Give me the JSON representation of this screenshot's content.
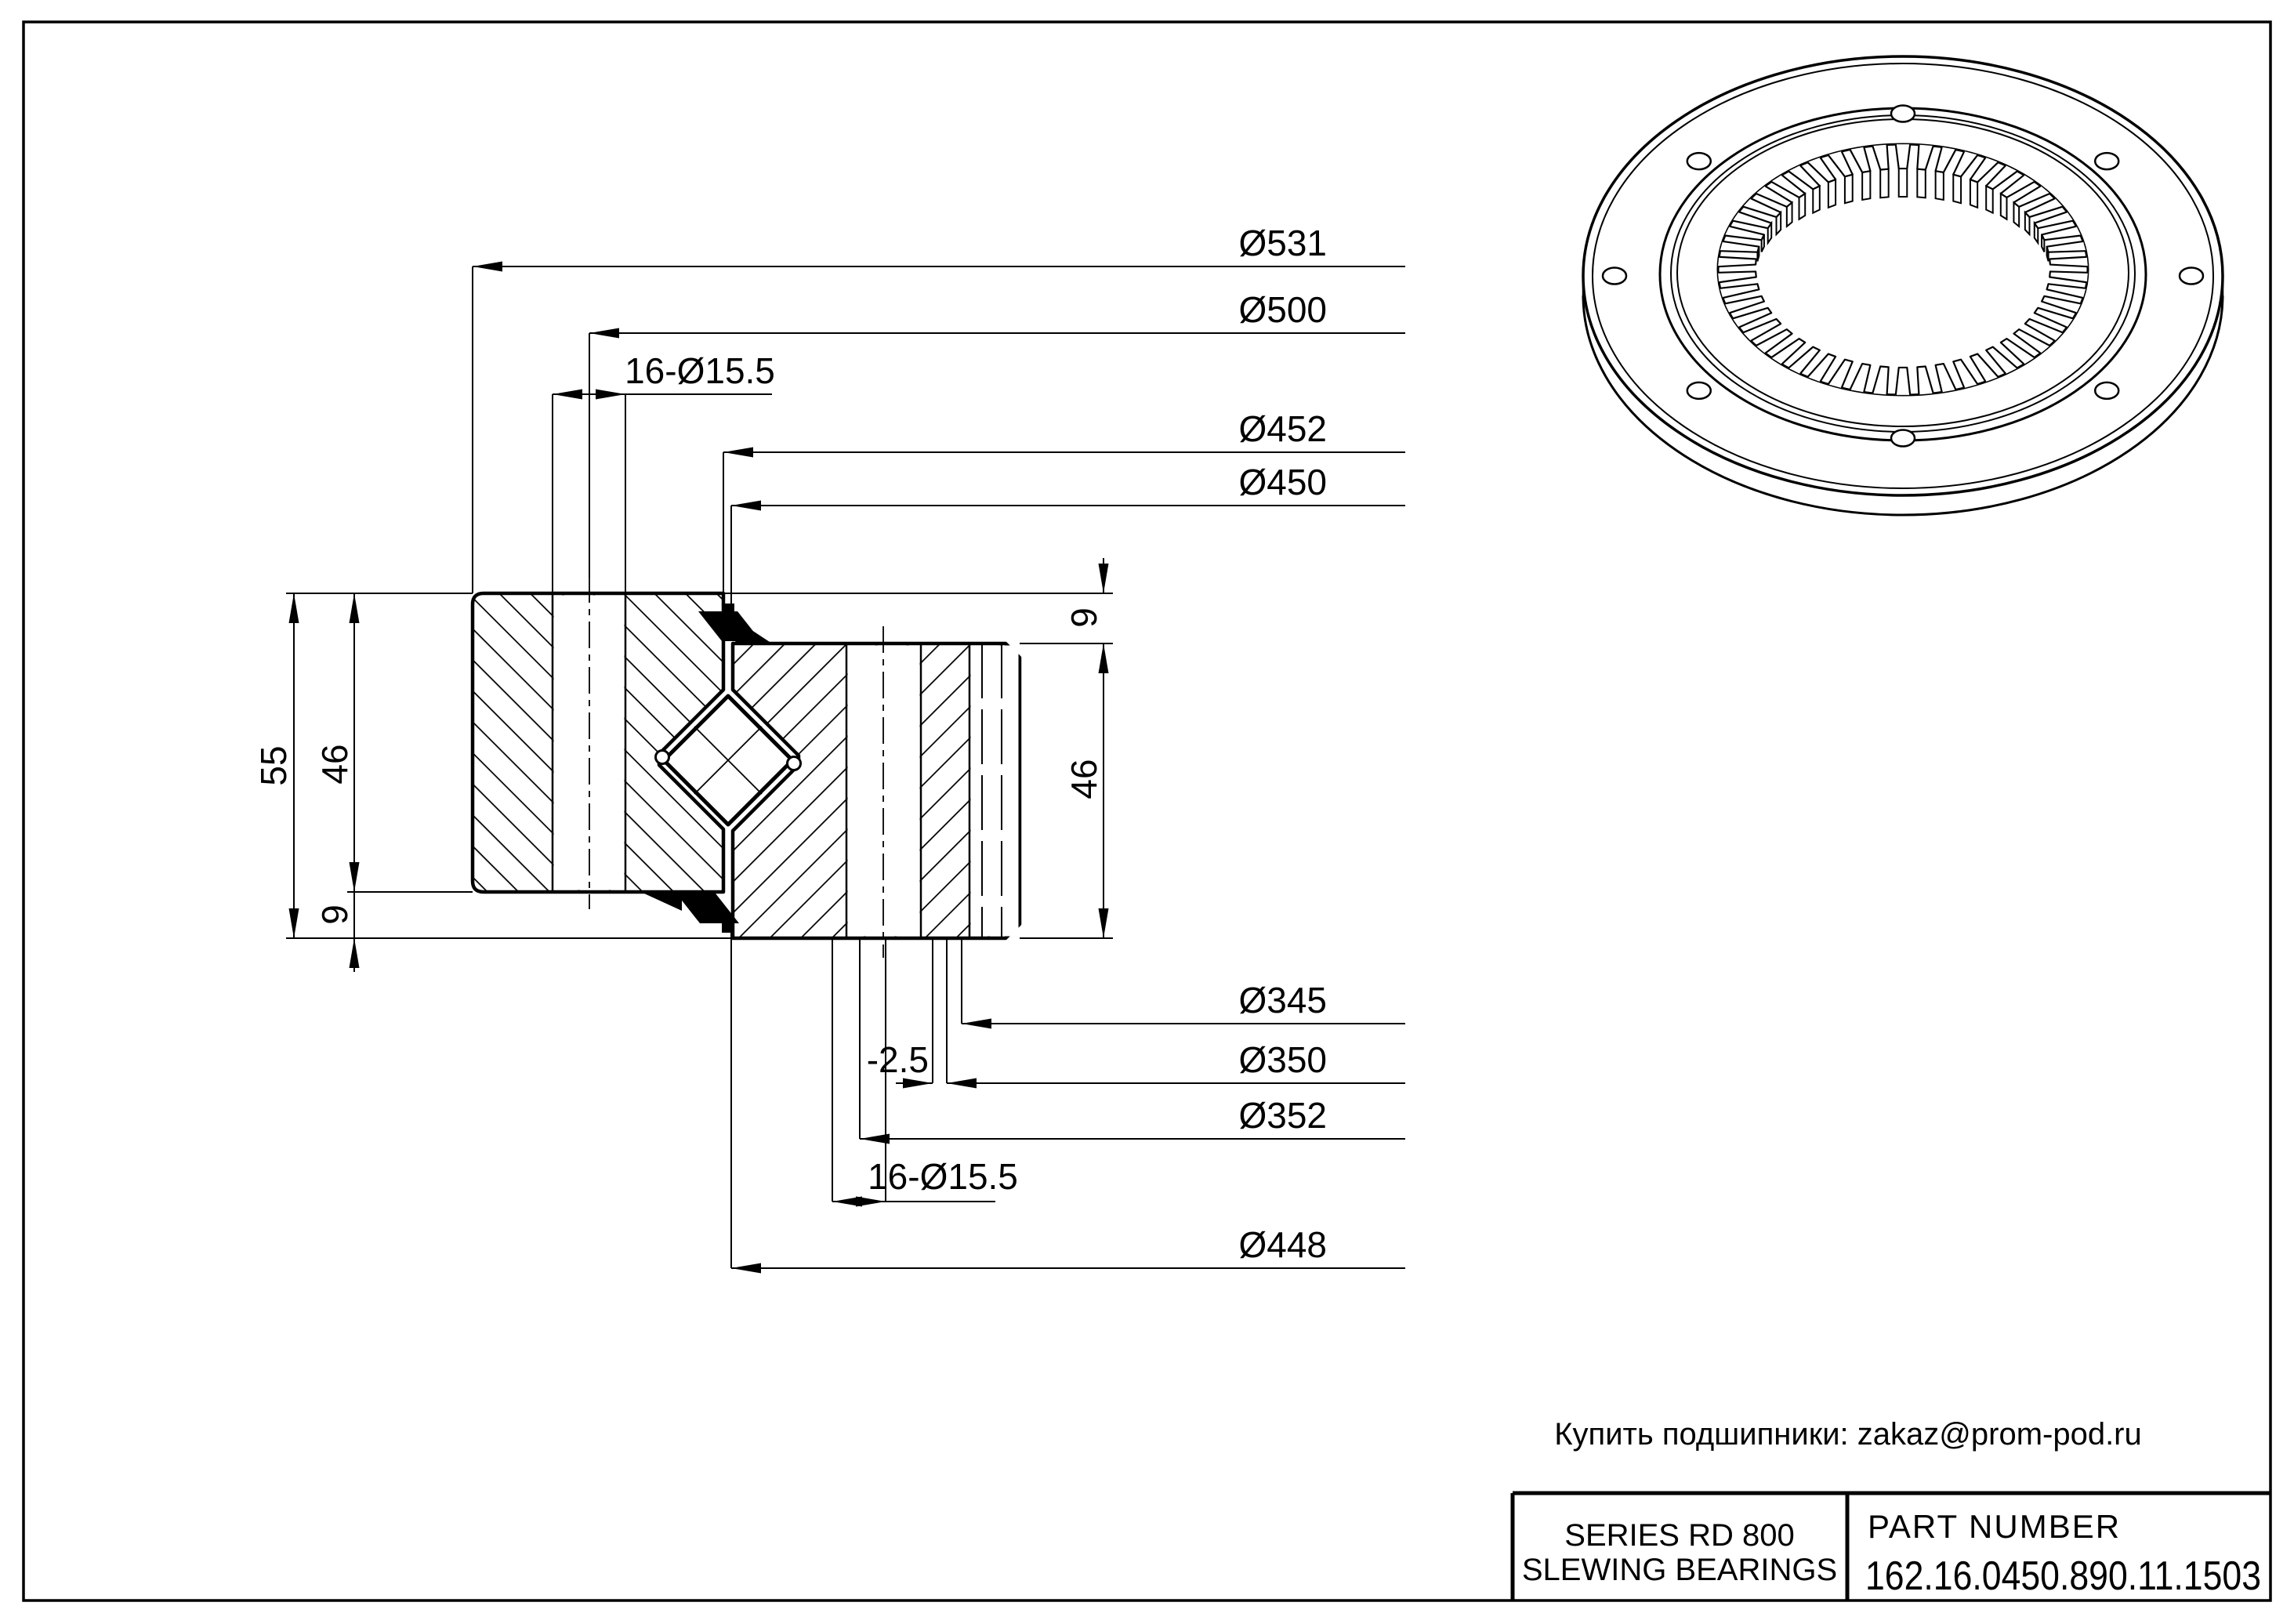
{
  "sheet": {
    "background": "#ffffff",
    "line_color": "#000000"
  },
  "dimensions": {
    "top": [
      {
        "id": "d531",
        "label": "Ø531"
      },
      {
        "id": "d500",
        "label": "Ø500"
      },
      {
        "id": "holes_top",
        "label": "16-Ø15.5"
      },
      {
        "id": "d452",
        "label": "Ø452"
      },
      {
        "id": "d450",
        "label": "Ø450"
      }
    ],
    "bottom": [
      {
        "id": "d345",
        "label": "Ø345"
      },
      {
        "id": "d350",
        "label": "Ø350"
      },
      {
        "id": "offset",
        "label": "-2.5"
      },
      {
        "id": "d352",
        "label": "Ø352"
      },
      {
        "id": "holes_bottom",
        "label": "16-Ø15.5"
      },
      {
        "id": "d448",
        "label": "Ø448"
      }
    ],
    "vertical": [
      {
        "id": "h55",
        "label": "55"
      },
      {
        "id": "h46_left",
        "label": "46"
      },
      {
        "id": "h9_bottom",
        "label": "9"
      },
      {
        "id": "h9_top",
        "label": "9"
      },
      {
        "id": "h46_right",
        "label": "46"
      }
    ]
  },
  "contact": {
    "text": "Купить подшипники: zakaz@prom-pod.ru"
  },
  "title_block": {
    "series_line1": "SERIES  RD  800",
    "series_line2": "SLEWING BEARINGS",
    "part_number_label": "PART  NUMBER",
    "part_number": "162.16.0450.890.11.1503"
  },
  "geometry": {
    "teeth_count": 50,
    "bolt_holes": 8
  }
}
